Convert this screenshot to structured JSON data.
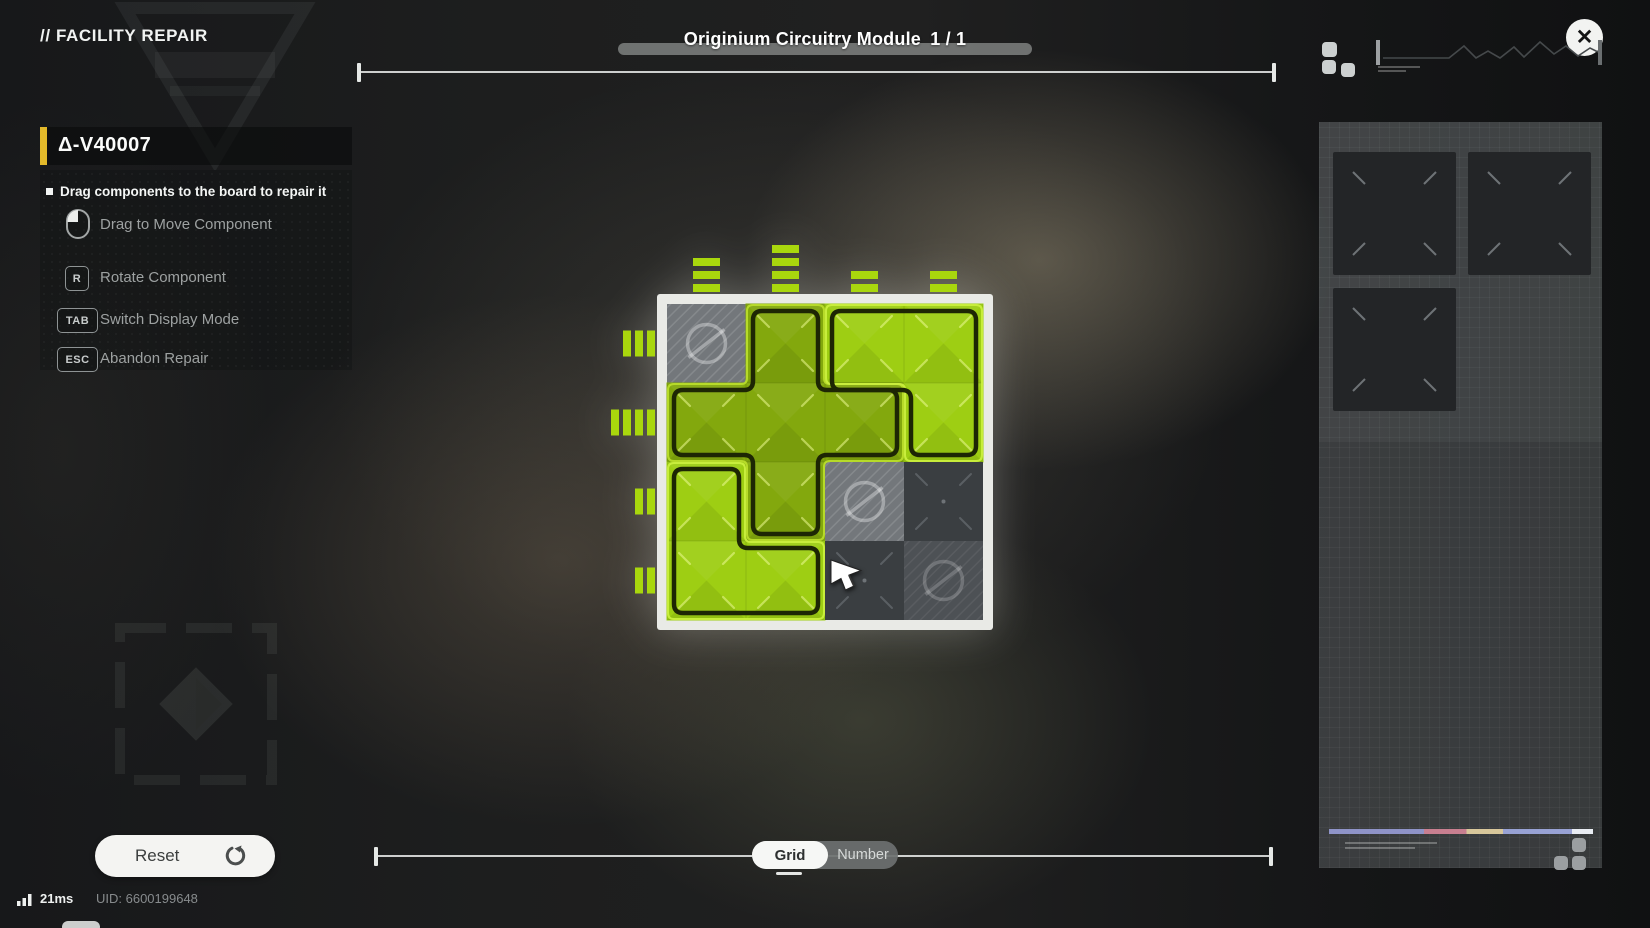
{
  "header": {
    "breadcrumb": "// FACILITY REPAIR"
  },
  "title": {
    "label": "Originium Circuitry Module",
    "counter": "1 / 1"
  },
  "close": {
    "glyph": "✕"
  },
  "info_panel": {
    "module_id": "Δ-V40007",
    "hint": "Drag components to the board to repair it",
    "controls": [
      {
        "key": "",
        "icon": "mouse-left-icon",
        "label": "Drag to Move Component"
      },
      {
        "key": "R",
        "label": "Rotate Component"
      },
      {
        "key": "TAB",
        "label": "Switch Display Mode"
      },
      {
        "key": "ESC",
        "label": "Abandon Repair"
      }
    ]
  },
  "board": {
    "rows": 4,
    "cols": 4,
    "cell_size": 79,
    "cells": [
      [
        "blocked",
        "A",
        "B",
        "B"
      ],
      [
        "A",
        "A",
        "A",
        "B"
      ],
      [
        "C",
        "A",
        "blocked",
        "empty"
      ],
      [
        "C",
        "C",
        "empty",
        "blocked_dark"
      ]
    ],
    "pieces": {
      "A": {
        "color": "#83a80d",
        "highlight": "#b9dd2b",
        "cells": [
          [
            1,
            0
          ],
          [
            0,
            1
          ],
          [
            1,
            1
          ],
          [
            2,
            1
          ],
          [
            1,
            2
          ]
        ],
        "outer": [
          [
            80,
            1
          ],
          [
            157,
            1
          ],
          [
            157,
            80
          ],
          [
            236,
            80
          ],
          [
            236,
            157
          ],
          [
            157,
            157
          ],
          [
            157,
            236
          ],
          [
            80,
            236
          ],
          [
            80,
            157
          ],
          [
            1,
            157
          ],
          [
            1,
            80
          ],
          [
            80,
            80
          ]
        ],
        "inner": [
          [
            86,
            7
          ],
          [
            151,
            7
          ],
          [
            151,
            86
          ],
          [
            230,
            86
          ],
          [
            230,
            151
          ],
          [
            151,
            151
          ],
          [
            151,
            230
          ],
          [
            86,
            230
          ],
          [
            86,
            151
          ],
          [
            7,
            151
          ],
          [
            7,
            86
          ],
          [
            86,
            86
          ]
        ]
      },
      "B": {
        "color": "#9ece13",
        "highlight": "#caef3e",
        "cells": [
          [
            2,
            0
          ],
          [
            3,
            0
          ],
          [
            3,
            1
          ]
        ],
        "outer": [
          [
            159,
            1
          ],
          [
            315,
            1
          ],
          [
            315,
            157
          ],
          [
            238,
            157
          ],
          [
            238,
            80
          ],
          [
            159,
            80
          ]
        ],
        "inner": [
          [
            165,
            7
          ],
          [
            309,
            7
          ],
          [
            309,
            151
          ],
          [
            244,
            151
          ],
          [
            244,
            86
          ],
          [
            165,
            86
          ]
        ]
      },
      "C": {
        "color": "#9ece13",
        "highlight": "#caef3e",
        "cells": [
          [
            0,
            2
          ],
          [
            0,
            3
          ],
          [
            1,
            3
          ]
        ],
        "outer": [
          [
            1,
            159
          ],
          [
            78,
            159
          ],
          [
            78,
            238
          ],
          [
            157,
            238
          ],
          [
            157,
            315
          ],
          [
            1,
            315
          ]
        ],
        "inner": [
          [
            7,
            165
          ],
          [
            72,
            165
          ],
          [
            72,
            244
          ],
          [
            151,
            244
          ],
          [
            151,
            309
          ],
          [
            7,
            309
          ]
        ]
      }
    },
    "pins_top": [
      3,
      4,
      2,
      2
    ],
    "pins_left": [
      3,
      4,
      2,
      2
    ],
    "colors": {
      "frame": "#e9eae6",
      "interior": "#2c2f31",
      "pin": "#a9d70d",
      "outline": "#1d2604",
      "blocked": "#73777b",
      "blocked_dark": "#4d5155",
      "empty": "#3a3e41"
    }
  },
  "footer": {
    "reset_label": "Reset",
    "toggle": [
      "Grid",
      "Number"
    ],
    "toggle_selected": "Grid",
    "ping": "21ms",
    "uid": "UID: 6600199648"
  },
  "sidebar": {
    "stripe_colors": [
      "#8f94c8",
      "#c87f90",
      "#d8c79b",
      "#98a2d4",
      "#e9edf3"
    ]
  }
}
